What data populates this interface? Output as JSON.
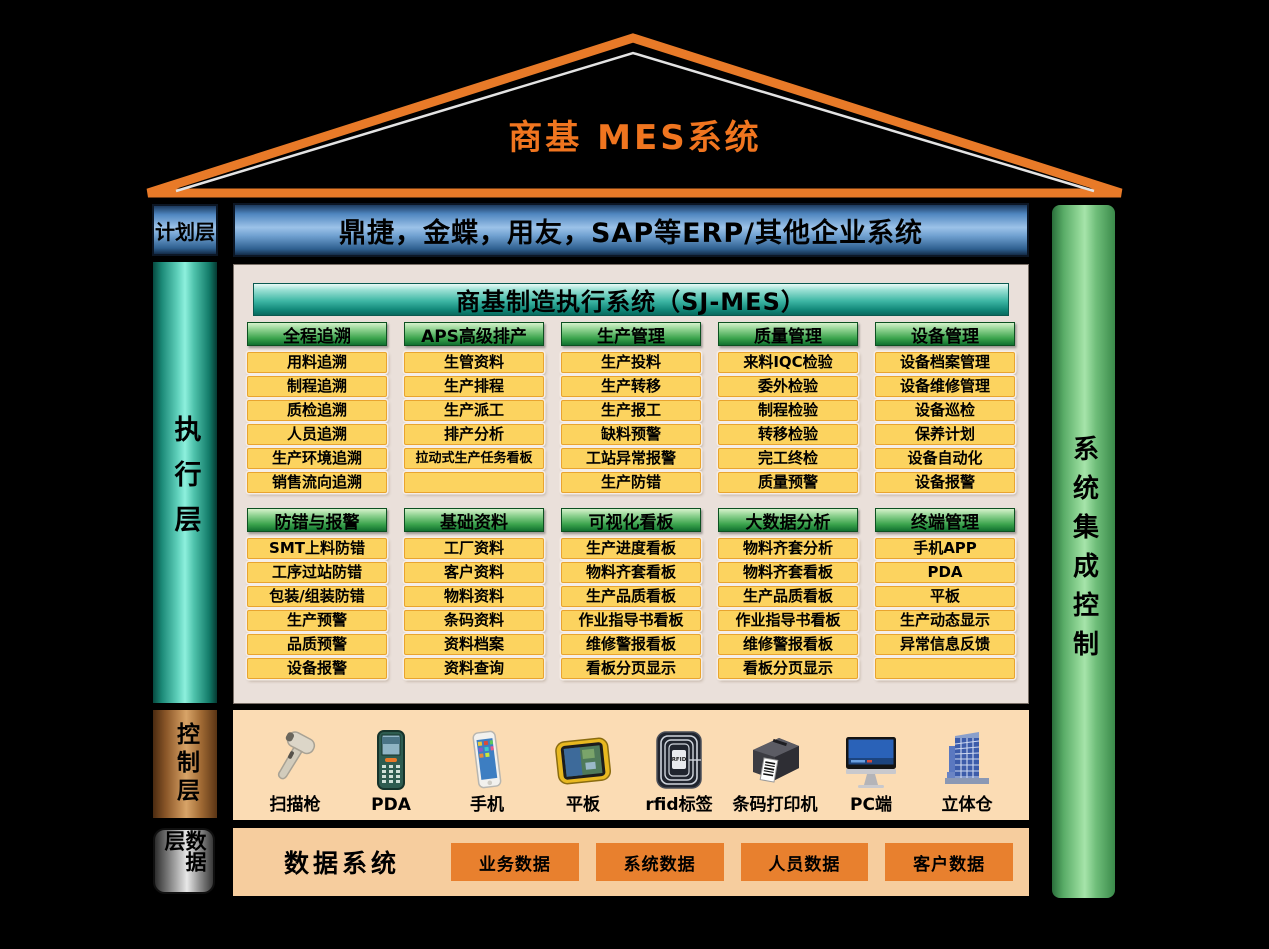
{
  "title": "商基  MES系统",
  "planning_layer": {
    "label": "计划层",
    "erp_bar": "鼎捷，金蝶，用友，SAP等ERP/其他企业系统"
  },
  "execution_layer": {
    "label": "执行层",
    "header": "商基制造执行系统（SJ-MES）",
    "groups": [
      {
        "title": "全程追溯",
        "items": [
          "用料追溯",
          "制程追溯",
          "质检追溯",
          "人员追溯",
          "生产环境追溯",
          "销售流向追溯"
        ]
      },
      {
        "title": "APS高级排产",
        "items": [
          "生管资料",
          "生产排程",
          "生产派工",
          "排产分析",
          "拉动式生产任务看板",
          ""
        ]
      },
      {
        "title": "生产管理",
        "items": [
          "生产投料",
          "生产转移",
          "生产报工",
          "缺料预警",
          "工站异常报警",
          "生产防错"
        ]
      },
      {
        "title": "质量管理",
        "items": [
          "来料IQC检验",
          "委外检验",
          "制程检验",
          "转移检验",
          "完工终检",
          "质量预警"
        ]
      },
      {
        "title": "设备管理",
        "items": [
          "设备档案管理",
          "设备维修管理",
          "设备巡检",
          "保养计划",
          "设备自动化",
          "设备报警"
        ]
      },
      {
        "title": "防错与报警",
        "items": [
          "SMT上料防错",
          "工序过站防错",
          "包装/组装防错",
          "生产预警",
          "品质预警",
          "设备报警"
        ]
      },
      {
        "title": "基础资料",
        "items": [
          "工厂资料",
          "客户资料",
          "物料资料",
          "条码资料",
          "资料档案",
          "资料查询"
        ]
      },
      {
        "title": "可视化看板",
        "items": [
          "生产进度看板",
          "物料齐套看板",
          "生产品质看板",
          "作业指导书看板",
          "维修警报看板",
          "看板分页显示"
        ]
      },
      {
        "title": "大数据分析",
        "items": [
          "物料齐套分析",
          "物料齐套看板",
          "生产品质看板",
          "作业指导书看板",
          "维修警报看板",
          "看板分页显示"
        ]
      },
      {
        "title": "终端管理",
        "items": [
          "手机APP",
          "PDA",
          "平板",
          "生产动态显示",
          "异常信息反馈",
          ""
        ]
      }
    ]
  },
  "control_layer": {
    "label": "控制层",
    "devices": [
      {
        "name": "扫描枪",
        "icon": "scanner-gun-icon"
      },
      {
        "name": "PDA",
        "icon": "pda-icon"
      },
      {
        "name": "手机",
        "icon": "phone-icon"
      },
      {
        "name": "平板",
        "icon": "tablet-icon"
      },
      {
        "name": "rfid标签",
        "icon": "rfid-tag-icon"
      },
      {
        "name": "条码打印机",
        "icon": "barcode-printer-icon"
      },
      {
        "name": "PC端",
        "icon": "pc-icon"
      },
      {
        "name": "立体仓",
        "icon": "warehouse-icon"
      }
    ]
  },
  "data_layer": {
    "label": "数据层",
    "system_title": "数据系统",
    "databases": [
      "业务数据",
      "系统数据",
      "人员数据",
      "客户数据"
    ]
  },
  "right_bar": {
    "label": "系统集成控制"
  },
  "colors": {
    "roof_orange": "#E87A28",
    "title_orange": "#F0751F",
    "erp_blue": "#6FA0D0",
    "exec_teal": "#5ECFBA",
    "group_green": "#3AA34C",
    "item_yellow": "#FCD35F",
    "item_border": "#E9A42F",
    "panel_gray": "#EAE0DA",
    "control_copper": "#C89258",
    "peach_panel": "#FBDCB4",
    "data_orange": "#E8802E",
    "right_green": "#8ED494"
  }
}
